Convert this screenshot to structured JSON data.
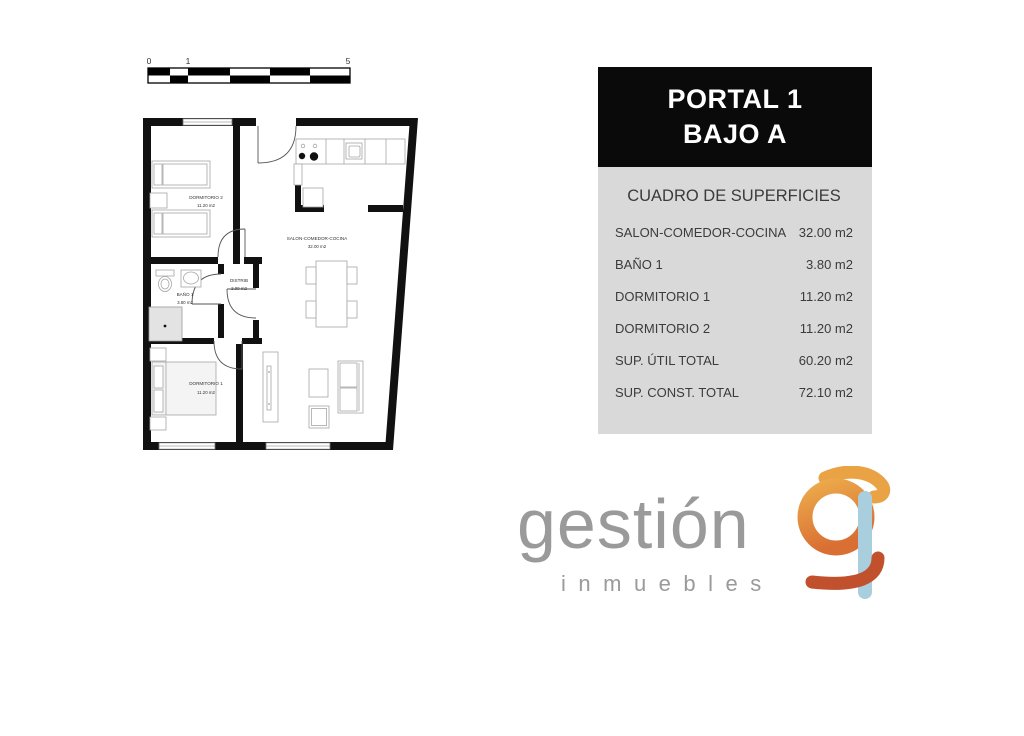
{
  "scale_bar": {
    "labels": [
      "0",
      "1",
      "5"
    ]
  },
  "plan": {
    "rooms": [
      {
        "name": "DORMITORIO 2",
        "area": "11.20 m2"
      },
      {
        "name": "SALON-COMEDOR-COCINA",
        "area": "32.00 m2"
      },
      {
        "name": "BAÑO 1",
        "area": "3.80 m2"
      },
      {
        "name": "DISTRIB",
        "area": "2.00 m2"
      },
      {
        "name": "DORMITORIO 1",
        "area": "11.20 m2"
      }
    ]
  },
  "panel": {
    "header_line1": "PORTAL 1",
    "header_line2": "BAJO A",
    "table_title": "CUADRO DE SUPERFICIES",
    "rows": [
      {
        "label": "SALON-COMEDOR-COCINA",
        "value": "32.00 m2"
      },
      {
        "label": "BAÑO 1",
        "value": "3.80 m2"
      },
      {
        "label": "DORMITORIO 1",
        "value": "11.20 m2"
      },
      {
        "label": "DORMITORIO 2",
        "value": "11.20 m2"
      },
      {
        "label": "SUP. ÚTIL TOTAL",
        "value": "60.20 m2"
      },
      {
        "label": "SUP. CONST. TOTAL",
        "value": "72.10 m2"
      }
    ]
  },
  "logo": {
    "brand": "gestión",
    "tagline": "inmuebles"
  },
  "colors": {
    "header_bg": "#0a0a0a",
    "table_bg": "#d9d9d9",
    "text": "#3b3b3b",
    "wall": "#111111",
    "logo_gray": "#9a9a9a",
    "logo_orange": "#e8923f",
    "logo_amber": "#e9a344",
    "logo_blue": "#a9cede",
    "logo_rust": "#c1502c"
  }
}
